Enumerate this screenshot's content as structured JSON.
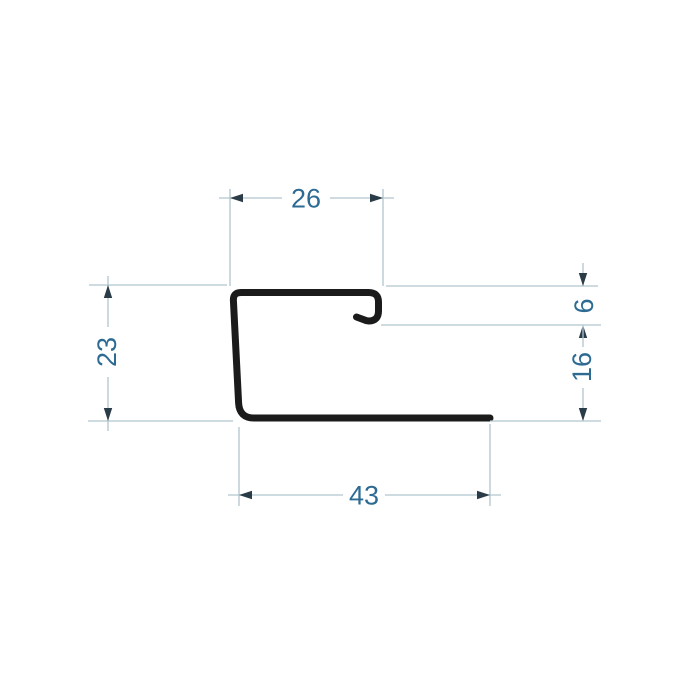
{
  "drawing": {
    "kind": "technical-profile-cross-section",
    "background_color": "#ffffff",
    "profile_color": "#1b1b1b",
    "dimension_line_color": "#b0c6d0",
    "arrow_color": "#2b3c49",
    "dimension_text_color": "#2e6b93",
    "dimensions": {
      "top_width": "26",
      "left_height": "23",
      "hook_height": "6",
      "right_lower_height": "16",
      "bottom_width": "43"
    }
  }
}
